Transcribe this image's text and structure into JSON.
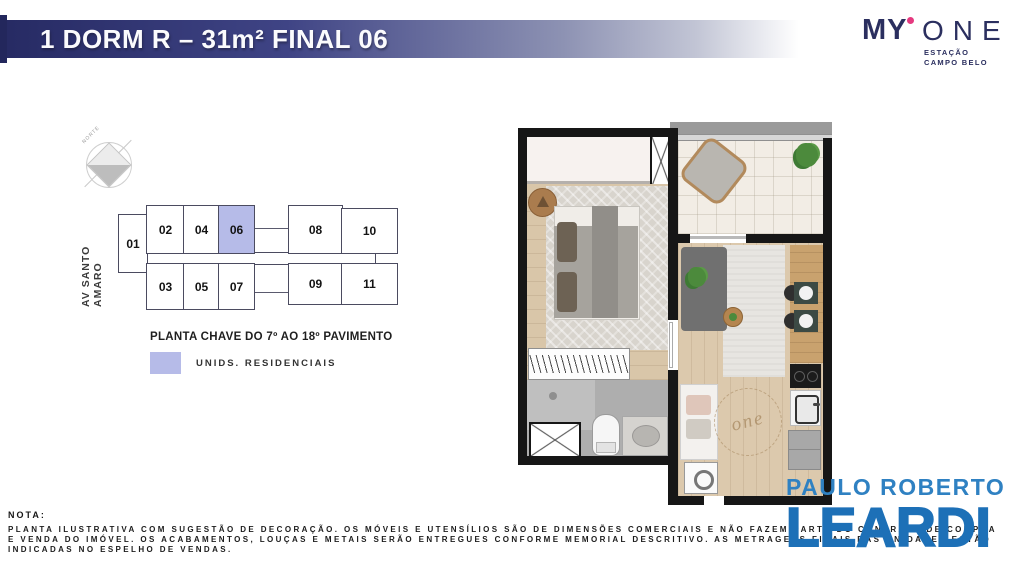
{
  "header": {
    "title": "1 DORM R – 31m² FINAL 06"
  },
  "brand": {
    "name_bold": "MY",
    "name_light": "ONE",
    "sub_line1": "ESTAÇÃO",
    "sub_line2": "CAMPO BELO",
    "accent_pink": "#e5397f",
    "navy": "#2b2f5f"
  },
  "keyplan": {
    "compass_label": "NORTE",
    "street_label": "AV SANTO AMARO",
    "title": "PLANTA CHAVE DO 7º AO 18º PAVIMENTO",
    "legend_label": "UNIDS. RESIDENCIAIS",
    "highlight_color": "#b6bbe8",
    "highlight_unit": "06",
    "units": [
      "01",
      "02",
      "03",
      "04",
      "05",
      "06",
      "07",
      "08",
      "09",
      "10",
      "11"
    ]
  },
  "floorplan": {
    "watermark": "one"
  },
  "note": {
    "label": "NOTA:",
    "lines": [
      "PLANTA ILUSTRATIVA COM SUGESTÃO DE DECORAÇÃO. OS MÓVEIS E UTENSÍLIOS SÃO DE DIMENSÕES COMERCIAIS E NÃO FAZEM PARTE DO CONTRATO DE COMPRA",
      "E VENDA DO IMÓVEL. OS ACABAMENTOS, LOUÇAS E METAIS SERÃO ENTREGUES CONFORME MEMORIAL DESCRITIVO. AS METRAGENS FINAIS DAS UNIDADES ESTÃO",
      "INDICADAS NO ESPELHO DE VENDAS."
    ]
  },
  "realtor": {
    "line1": "PAULO ROBERTO",
    "line2": "LEARDI",
    "blue": "#1d70b7"
  }
}
